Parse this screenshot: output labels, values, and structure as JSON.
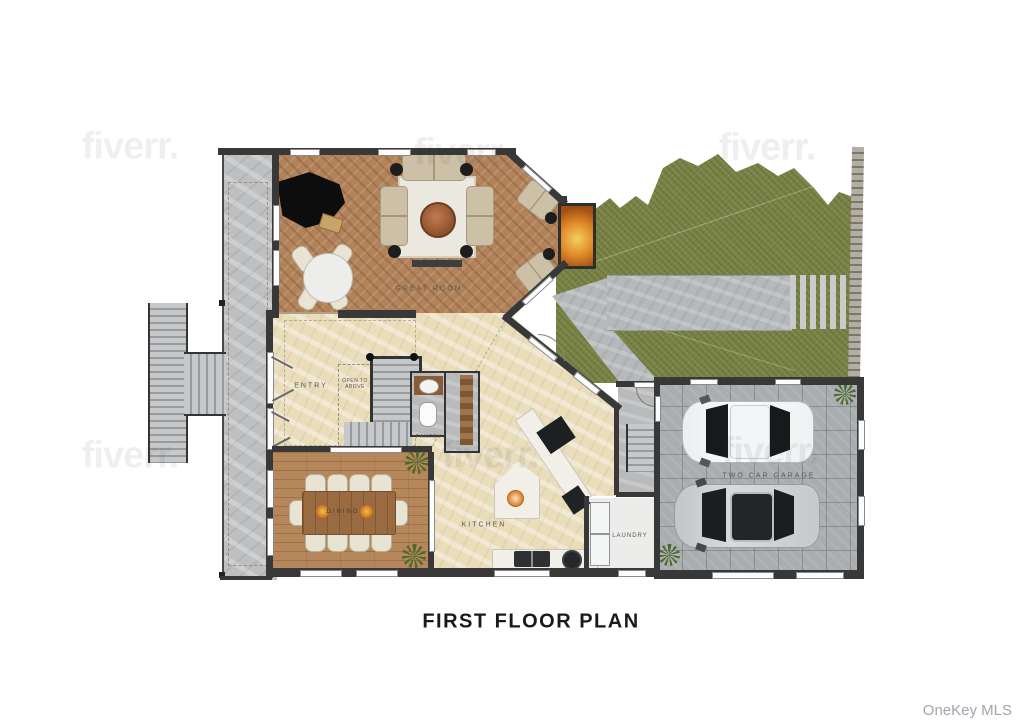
{
  "title": "FIRST FLOOR PLAN",
  "credit": "OneKey MLS",
  "watermark": {
    "text": "fiverr."
  },
  "rooms": {
    "great_room": {
      "label": "GREAT ROOM"
    },
    "entry": {
      "label": "ENTRY"
    },
    "open_to_above": {
      "line1": "OPEN TO",
      "line2": "ABOVE"
    },
    "pantry": {
      "label": "PANTRY"
    },
    "dining": {
      "label": "DINING"
    },
    "kitchen": {
      "label": "KITCHEN"
    },
    "laundry": {
      "label": "LAUNDRY"
    },
    "garage": {
      "label": "TWO CAR GARAGE"
    }
  },
  "palette": {
    "grass": "#7b8446",
    "herringbone_wood": "#b2835a",
    "plank_wood": "#b5875b",
    "marble_floor": "#e9ddbb",
    "garage_tile": "#aaadaf",
    "wall": "#383838",
    "fireplace_fire": "#e08a28",
    "title_text": "#1a1a1a",
    "credit_text": "#9fa6ad"
  }
}
